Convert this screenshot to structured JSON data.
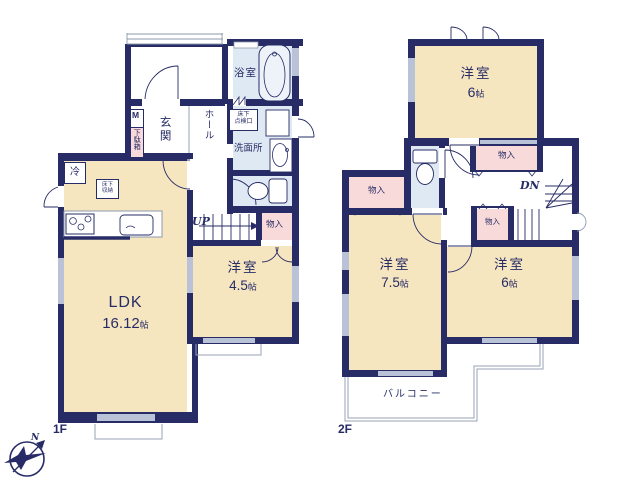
{
  "floor1": {
    "floor_label": "1F",
    "rooms": {
      "ldk": {
        "label": "LDK",
        "size_value": "16.12",
        "size_unit": "帖"
      },
      "bedroom": {
        "label": "洋室",
        "size_value": "4.5",
        "size_unit": "帖"
      },
      "entrance": {
        "label": "玄関"
      },
      "hall": {
        "label": "ホール"
      },
      "bath": {
        "label": "浴室"
      },
      "washroom": {
        "label": "洗面所"
      }
    },
    "features": {
      "meter_box": "M",
      "shoe_cabinet": "下駄箱",
      "fridge": "冷",
      "underfloor_storage": [
        "床下",
        "収納"
      ],
      "underfloor_hatch": [
        "床下",
        "点検口"
      ],
      "washer": "洗",
      "stairs_up": "UP",
      "closet": "物入"
    }
  },
  "floor2": {
    "floor_label": "2F",
    "rooms": {
      "bedroom_north": {
        "label": "洋室",
        "size_value": "6",
        "size_unit": "帖"
      },
      "bedroom_west": {
        "label": "洋室",
        "size_value": "7.5",
        "size_unit": "帖"
      },
      "bedroom_east": {
        "label": "洋室",
        "size_value": "6",
        "size_unit": "帖"
      }
    },
    "features": {
      "closet_west": "物入",
      "closet_north": "物入",
      "closet_center": "物入",
      "stairs_down": "DN",
      "balcony": "バルコニー"
    }
  },
  "compass": {
    "north_label": "N"
  },
  "colors": {
    "wall": "#272c66",
    "tatami_room": "#f6e6c0",
    "wet_area": "#dfe9f3",
    "closet": "#f8dada",
    "window": "#b9c2d6"
  }
}
